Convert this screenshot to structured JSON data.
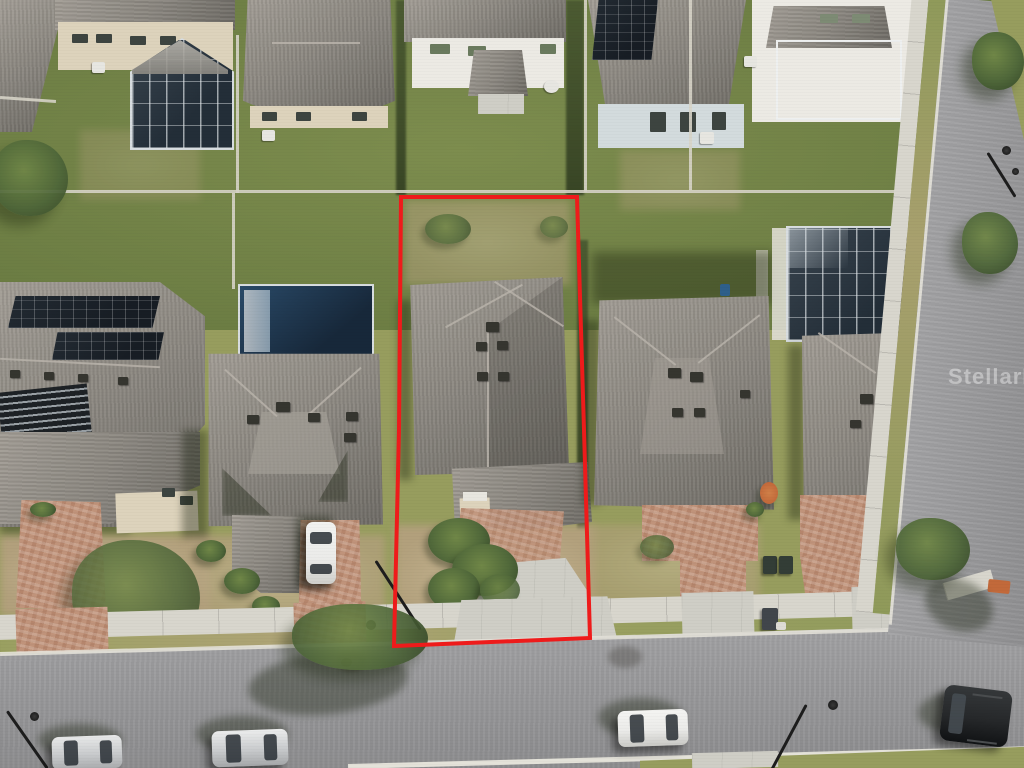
{
  "watermark": {
    "text": "StellarMLS"
  },
  "scene": {
    "outline_points": "401,197 577,197 584,430 590,638 394,646 399,430",
    "boundary_color": "#ee1b1b"
  },
  "palette": {
    "grass_front": "#979d5e",
    "grass_back": "#7d8d4e",
    "dirt": "#b2a07c",
    "dirt_light": "#c7b794",
    "road": "#a4a4a6",
    "road_dark": "#8e8e90",
    "sidewalk": "#d8d6cd",
    "curb": "#e4e2d9",
    "roof_light": "#a29d95",
    "roof_mid": "#8b8780",
    "roof_dark": "#6e6b65",
    "ridge": "#b8b3aa",
    "wall_beige": "#ddd3bc",
    "wall_white": "#eceae4",
    "wall_blue": "#d3dbdd",
    "panel": "#171d24",
    "cage_dark": "#232e38",
    "cage_frame": "#d8dde0",
    "pool": "#17283a",
    "paver": "#c0937a",
    "concrete": "#cfcec6",
    "teal_porch": "#bcd6d0",
    "car_white": "#ebebe9",
    "car_silver": "#c9cbcd",
    "car_dark": "#26282a",
    "tree_dark": "#394d2b",
    "tree_mid": "#50683a",
    "tree_light": "#708747",
    "fence": "#d7d4c8",
    "bin": "#333d36",
    "accent_orange": "#c2693a",
    "boundary": "#ee1b1b",
    "watermark": "rgba(255,255,255,0.42)"
  }
}
